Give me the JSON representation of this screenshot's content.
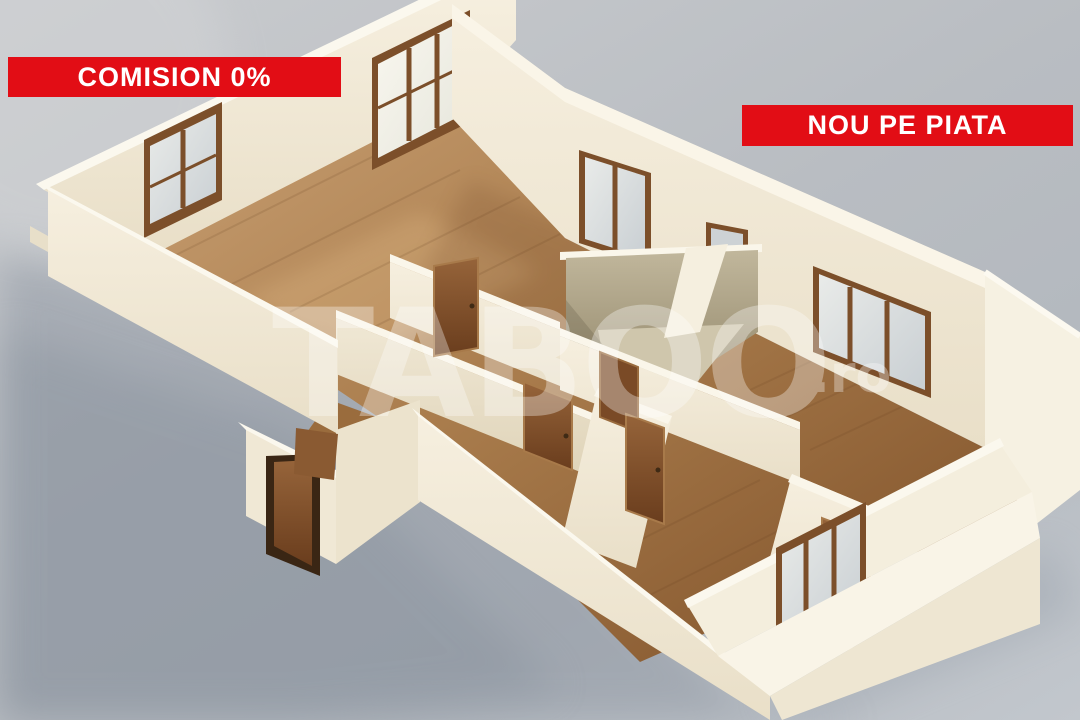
{
  "overlays": {
    "badge_commission": "COMISION 0%",
    "badge_new": "NOU PE PIATA",
    "watermark_brand": "TABOO",
    "watermark_tld": ".ro"
  },
  "colors": {
    "badge_background": "#e20d15",
    "badge_text": "#ffffff",
    "background_gray": "#bcc0c5",
    "shadow_gray": "#8e96a2",
    "wall_cream": "#f3ecdb",
    "wall_top_highlight": "#fbf7ec",
    "floor_wood_light": "#c49a6d",
    "floor_wood_dark": "#7c4e27",
    "bathroom_stone": "#b1a78c",
    "door_wood": "#8a5a2e",
    "entrance_door_dark": "#5f3a1f",
    "window_frame": "#7c4f2a",
    "window_glass": "#d4d9dc"
  }
}
